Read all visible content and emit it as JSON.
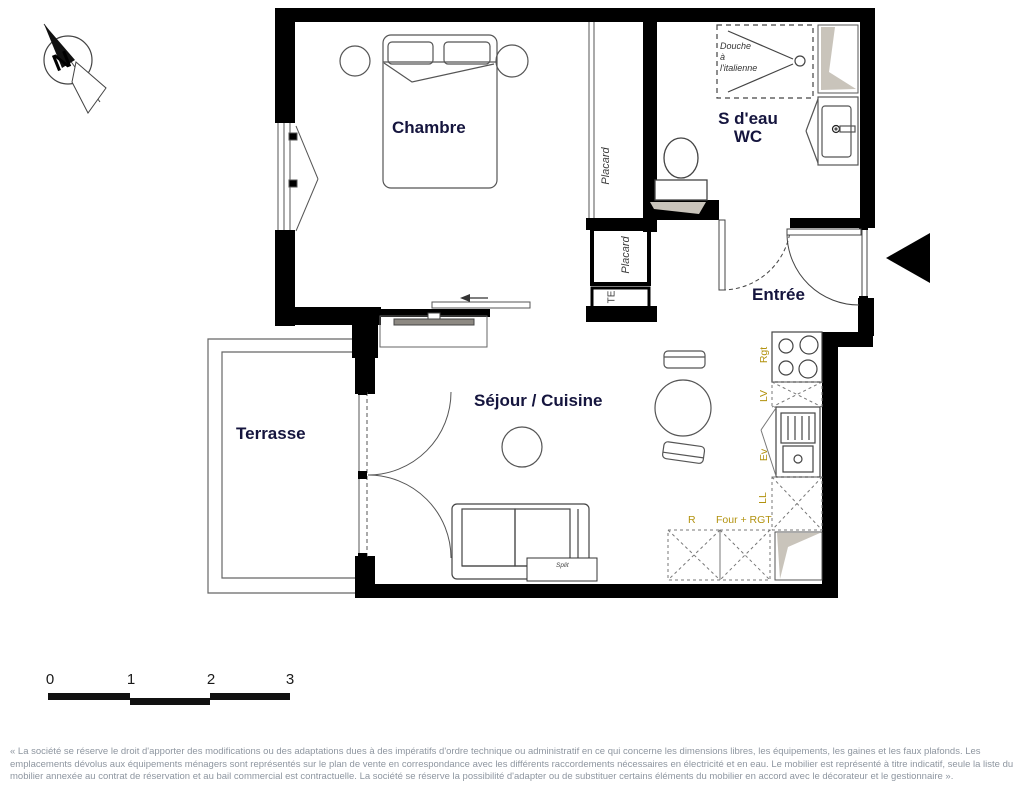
{
  "plan": {
    "rooms": {
      "chambre": "Chambre",
      "sdeau_wc": "S d'eau\nWC",
      "entree": "Entrée",
      "sejour_cuisine": "Séjour / Cuisine",
      "terrasse": "Terrasse"
    },
    "fixtures": {
      "douche": "Douche\nà\nl'italienne",
      "placard_upper": "Placard",
      "placard_lower": "Placard",
      "te": "TE",
      "split": "Split"
    },
    "kitchen_labels": {
      "rgt": "Rgt",
      "lv": "LV",
      "ev": "Ev",
      "ll": "LL",
      "r": "R",
      "four_rgt": "Four + RGT"
    },
    "compass": {
      "north": "N"
    },
    "scale_bar": {
      "ticks": [
        "0",
        "1",
        "2",
        "3"
      ]
    },
    "disclaimer": "« La société se réserve le droit d'apporter des modifications ou des adaptations dues à des impératifs d'ordre technique ou administratif en ce qui concerne les dimensions libres, les équipements, les gaines et les faux plafonds. Les emplacements dévolus aux équipements ménagers sont représentés sur le plan de vente en correspondance avec les différents raccordements nécessaires en électricité et en eau. Le mobilier est représenté à titre indicatif, seule la liste du mobilier annexée au contrat de réservation et au bail commercial est contractuelle. La société se réserve la possibilité d'adapter ou de substituer certains éléments du mobilier en accord avec le décorateur et le gestionnaire »."
  },
  "colors": {
    "wall": "#000000",
    "room_label": "#15153e",
    "appliance_label": "#b2920e",
    "duct_shading": "#c9c4bb",
    "disclaimer_text": "#8e96a0"
  }
}
